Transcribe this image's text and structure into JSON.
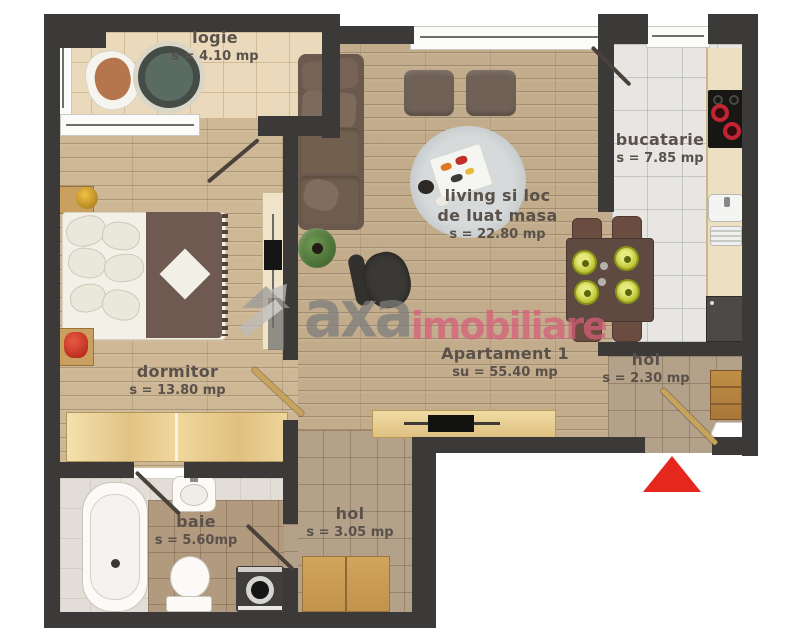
{
  "watermark": {
    "brand": "axa",
    "suffix": "imobiliare"
  },
  "rooms": {
    "logie": {
      "name": "logie",
      "area": "s = 4.10 mp"
    },
    "bucatarie": {
      "name": "bucatarie",
      "area": "s = 7.85 mp"
    },
    "living": {
      "name_line1": "living si loc",
      "name_line2": "de luat masa",
      "area": "s = 22.80 mp"
    },
    "apartament": {
      "name": "Apartament 1",
      "area": "su = 55.40 mp"
    },
    "dormitor": {
      "name": "dormitor",
      "area": "s = 13.80 mp"
    },
    "hol_entrance": {
      "name": "hol",
      "area": "s = 2.30 mp"
    },
    "baie": {
      "name": "baie",
      "area": "s = 5.60mp"
    },
    "hol_lower": {
      "name": "hol",
      "area": "s = 3.05 mp"
    }
  },
  "colors": {
    "wall": "#3b3a38",
    "entrance_arrow": "#e5271d",
    "watermark_gray": "#7d7d7d",
    "watermark_red": "#d5607a",
    "plate_yellow": "#c3c93a",
    "burner_red": "#c22434"
  }
}
